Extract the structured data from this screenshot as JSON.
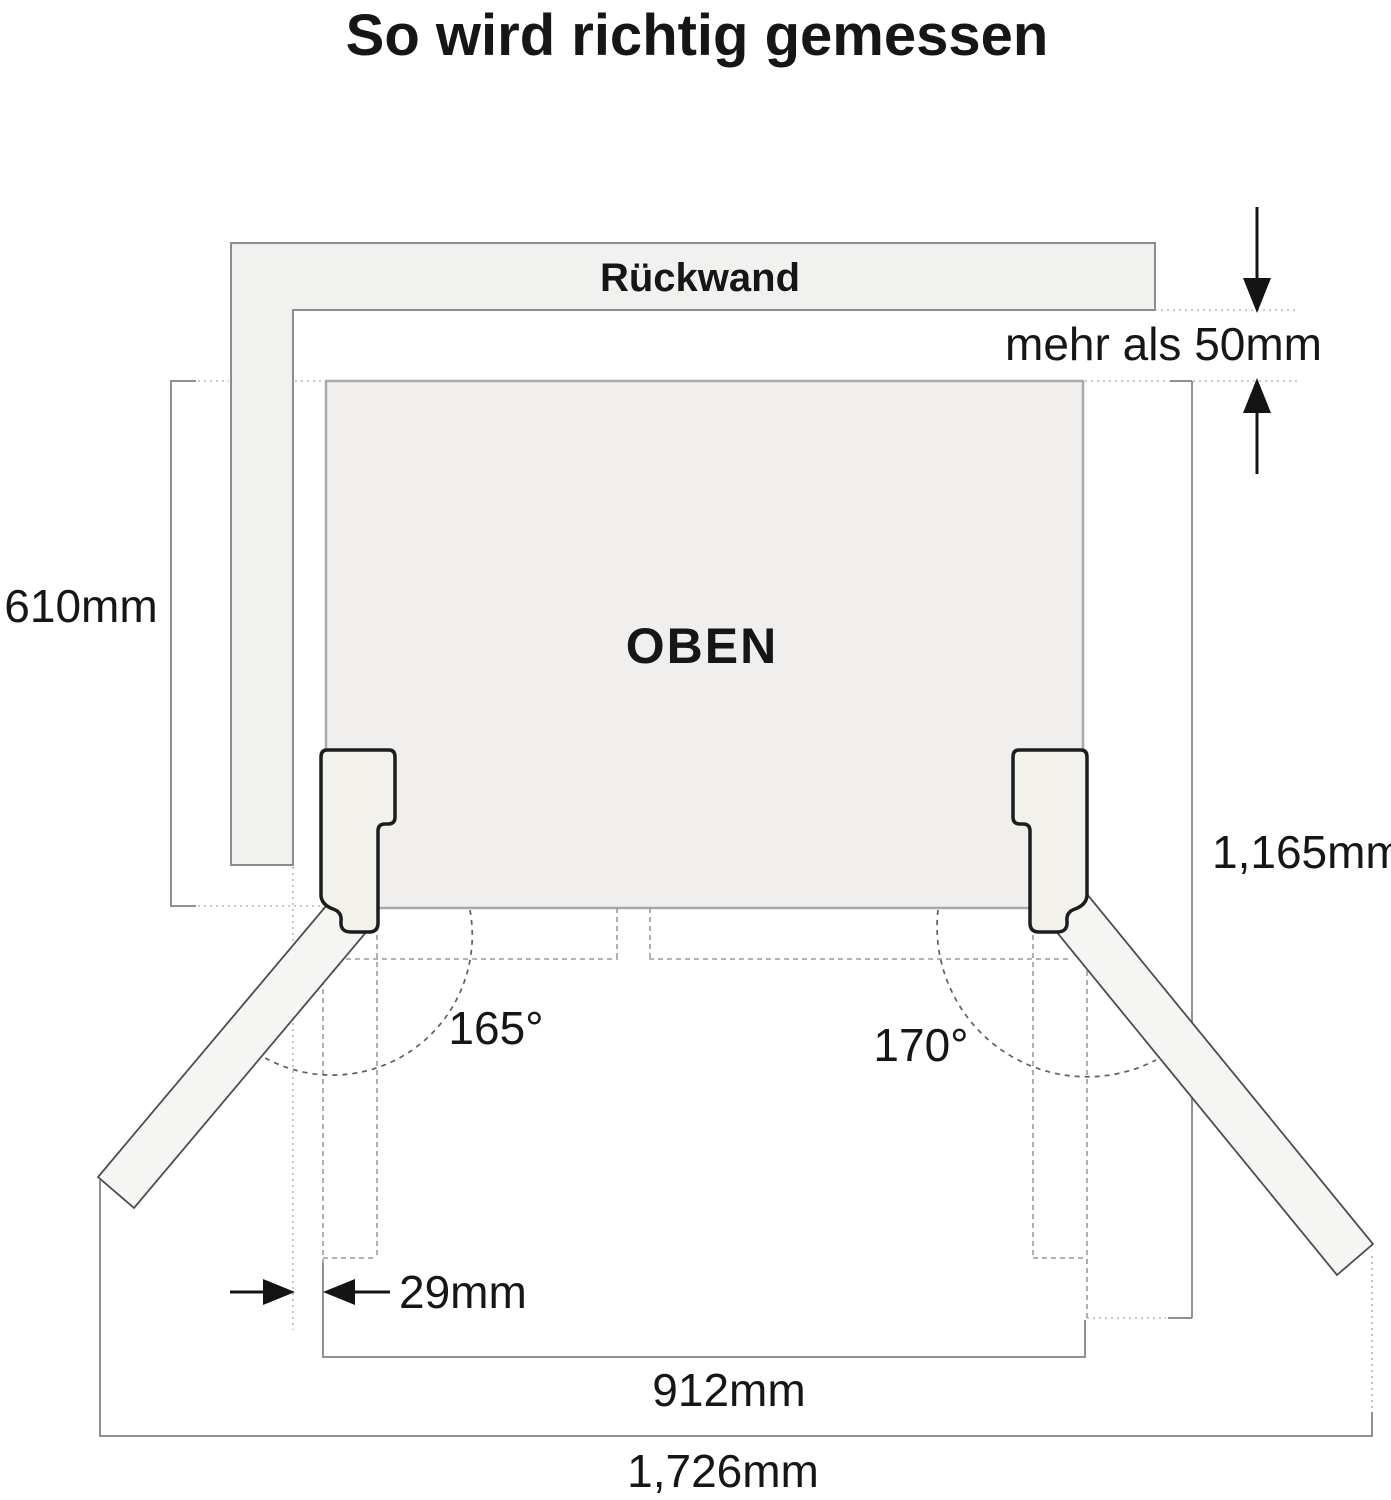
{
  "title": "So wird richtig gemessen",
  "wall": {
    "label": "Rückwand"
  },
  "cabinet": {
    "label": "OBEN"
  },
  "measurements": {
    "back_clearance": "mehr als 50mm",
    "cabinet_depth": "610mm",
    "depth_doors_open": "1,165mm",
    "left_gap": "29mm",
    "cabinet_width": "912mm",
    "total_width_doors_open": "1,726mm",
    "left_door_angle": "165°",
    "right_door_angle": "170°"
  },
  "icons": {
    "arrow_down": "arrow-down-icon",
    "arrow_up": "arrow-up-icon",
    "arrow_left": "arrow-left-icon",
    "arrow_right": "arrow-right-icon"
  },
  "colors": {
    "background": "#ffffff",
    "text": "#161616",
    "wall_fill": "#f1f1f0",
    "wall_stroke": "#8d8d8d",
    "cabinet_fill": "#f0efee",
    "cabinet_stroke": "#a9a9a9",
    "door_fill": "#f5f5f4",
    "door_stroke": "#4d4d4d",
    "hinge_fill": "#f2f1ec",
    "hinge_stroke": "#1d1d1d",
    "guide_dash": "#9a9a9a",
    "guide_dot": "#b5b5b5",
    "arc_dash": "#5f5f5f",
    "bracket": "#909090",
    "arrow": "#141414"
  }
}
